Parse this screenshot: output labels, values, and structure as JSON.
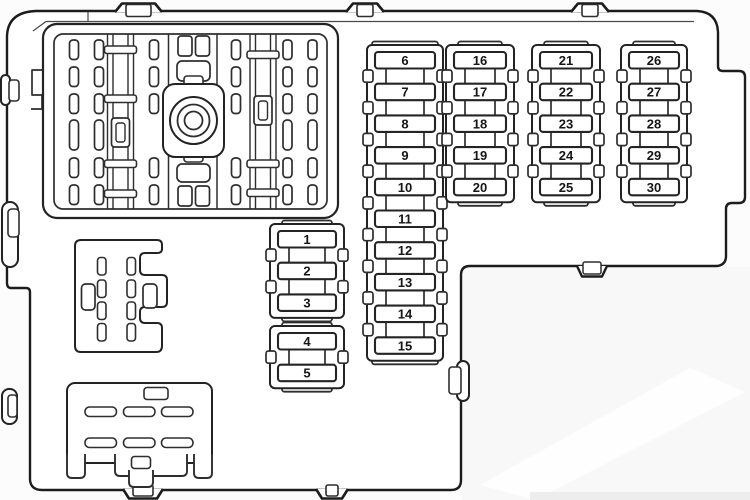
{
  "page": {
    "background": "#fcfcfc",
    "line_color": "#222222",
    "outline_color": "#1c1c1c",
    "fill_color": "#ffffff",
    "label_color": "#161616",
    "shadow_color": "#f8f8f8"
  },
  "fuse_strips": [
    {
      "name": "strip-1-5",
      "groups": [
        [
          "1",
          "2",
          "3"
        ],
        [
          "4",
          "5"
        ]
      ]
    },
    {
      "name": "strip-6-15",
      "groups": [
        [
          "6",
          "7",
          "8",
          "9",
          "10",
          "11",
          "12",
          "13",
          "14",
          "15"
        ]
      ]
    },
    {
      "name": "strip-16-20",
      "groups": [
        [
          "16",
          "17",
          "18",
          "19",
          "20"
        ]
      ]
    },
    {
      "name": "strip-21-25",
      "groups": [
        [
          "21",
          "22",
          "23",
          "24",
          "25"
        ]
      ]
    },
    {
      "name": "strip-26-30",
      "groups": [
        [
          "26",
          "27",
          "28",
          "29",
          "30"
        ]
      ]
    }
  ],
  "components": {
    "large_connector": "multi-pin-connector-with-center-bolt",
    "mid_left_connector": "small-pin-connector",
    "bottom_left_connector": "blade-connector"
  }
}
